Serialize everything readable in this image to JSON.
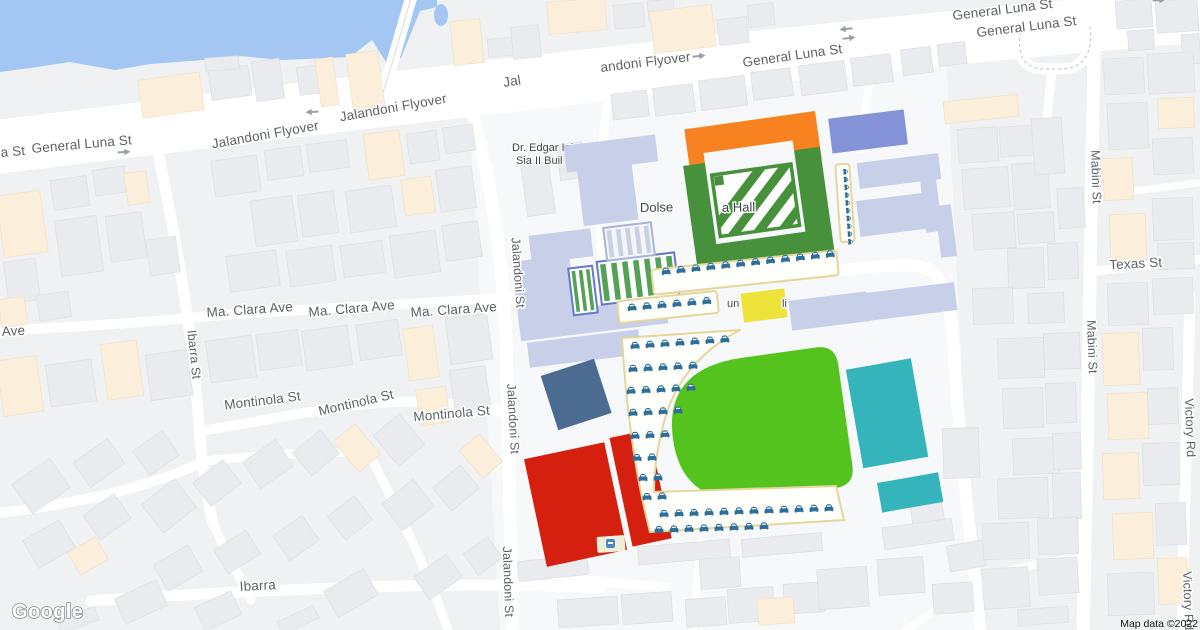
{
  "attribution": {
    "logo": "Google",
    "map_data": "Map data ©2022"
  },
  "streets": {
    "general_luna": "General Luna St",
    "jalandoni_flyover": "Jalandoni Flyover",
    "jalandoni_st": "Jalandoni St",
    "ibarra_st": "Ibarra St",
    "ibarra": "Ibarra",
    "ma_clara_ave": "Ma. Clara Ave",
    "montinola_st": "Montinola St",
    "mabini_st": "Mabini St",
    "texas_st": "Texas St",
    "victory_rd": "Victory Rd"
  },
  "fragments": {
    "a_st": "a St",
    "jal": "Jal",
    "andoni_flyover": "andoni Flyover",
    "ave": "Ave"
  },
  "pois": {
    "dr_edgar_line1": "Dr. Edgar Inje",
    "dr_edgar_line2": "Sia II Buil",
    "hall_left": "Dolse",
    "hall_right": "a Hall",
    "bldg_left": "un",
    "bldg_right": "li"
  },
  "icons": {
    "car": "car-icon",
    "one_way_arrow": "one-way-arrow-icon",
    "school": "school-poi-icon"
  },
  "colors": {
    "water": "#A3C6F3",
    "field_green": "#55C31D",
    "building_green": "#47903C",
    "orange": "#F8821F",
    "red": "#D6200F",
    "teal": "#36B4BB",
    "slate_blue": "#4C6B90",
    "indigo": "#8493D8",
    "periwinkle": "#C7CFE9",
    "yellow": "#EDE33B",
    "car_blue": "#2E6F99",
    "parking_outline": "#E5D69B",
    "shed_green": "#55A155",
    "shed_border": "#6679C8",
    "label_gray": "#5E6266",
    "poi_text": "#3E4347"
  }
}
